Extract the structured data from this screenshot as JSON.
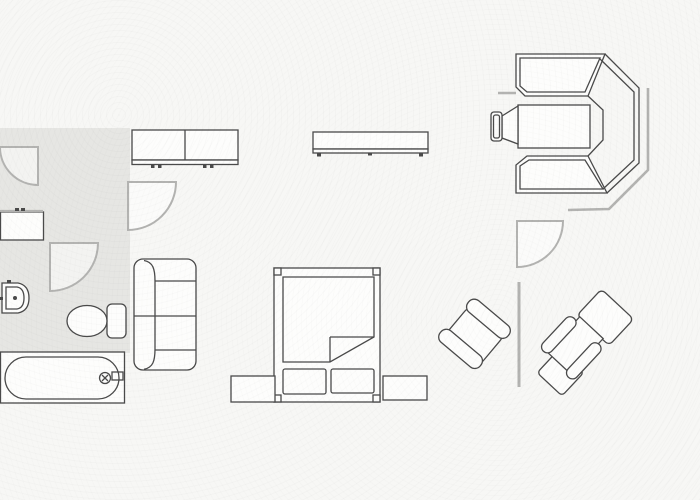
{
  "canvas": {
    "width": 700,
    "height": 500,
    "kind": "architectural floor plan, scanned line drawing, no text"
  },
  "colors": {
    "background": "#f7f7f5",
    "floor_tint": "#e6e6e3",
    "line": "#4a4a4a",
    "wall": "#b3b3b1",
    "furniture_fill": "#fdfdfc",
    "pie_fill": "rgba(255,255,255,0.5)"
  },
  "rooms": {
    "bathroom": {
      "floor_shaded": true,
      "contents": [
        "wall-cabinet",
        "washbasin",
        "toilet",
        "bathtub"
      ]
    },
    "living_sleeping_area": {
      "floor_shaded": false,
      "contents": [
        "sofa",
        "wardrobe",
        "sideboard",
        "double-bed",
        "nightstand-left",
        "nightstand-right"
      ]
    },
    "study_corner": {
      "floor_shaded": false,
      "contents": [
        "corner-workstation",
        "desk-table",
        "desk-chair",
        "armchair-left",
        "armchair-right-with-ottoman"
      ]
    }
  },
  "elements": [
    {
      "name": "door-swing-top-left",
      "type": "door swing symbol, opens down-left"
    },
    {
      "name": "door-swing-hall",
      "type": "door swing symbol, hinge top-left"
    },
    {
      "name": "door-swing-bathroom",
      "type": "door swing symbol, hinge top-left"
    },
    {
      "name": "door-swing-right",
      "type": "door swing symbol, hinge top-left"
    },
    {
      "name": "bay-wall",
      "type": "angled wall line along corner workstation"
    },
    {
      "name": "wall-divider-right",
      "type": "short interior wall segment"
    },
    {
      "name": "wall-cabinet",
      "type": "small cabinet on left wall"
    },
    {
      "name": "washbasin",
      "type": "D-shaped sink with tap dot"
    },
    {
      "name": "toilet",
      "type": "toilet with cistern and oval bowl"
    },
    {
      "name": "bathtub",
      "type": "bathtub with rounded inner tub and tap"
    },
    {
      "name": "sofa",
      "type": "two-seat sofa, back on left"
    },
    {
      "name": "wardrobe",
      "type": "two-door wardrobe with plinth and feet"
    },
    {
      "name": "sideboard",
      "type": "long low sideboard with feet"
    },
    {
      "name": "double-bed",
      "type": "bed with corner posts, folded blanket corner, two pillows"
    },
    {
      "name": "nightstand-left",
      "type": "bedside table"
    },
    {
      "name": "nightstand-right",
      "type": "bedside table"
    },
    {
      "name": "corner-workstation",
      "type": "octagonal corner desk / bay unit with glazed corner"
    },
    {
      "name": "desk-table",
      "type": "rectangular desk inside corner unit"
    },
    {
      "name": "desk-chair",
      "type": "chair with backrest at desk"
    },
    {
      "name": "armchair-left",
      "type": "armchair rotated 45 degrees"
    },
    {
      "name": "armchair-right",
      "type": "armchair with ottoman rotated 45 degrees"
    }
  ]
}
